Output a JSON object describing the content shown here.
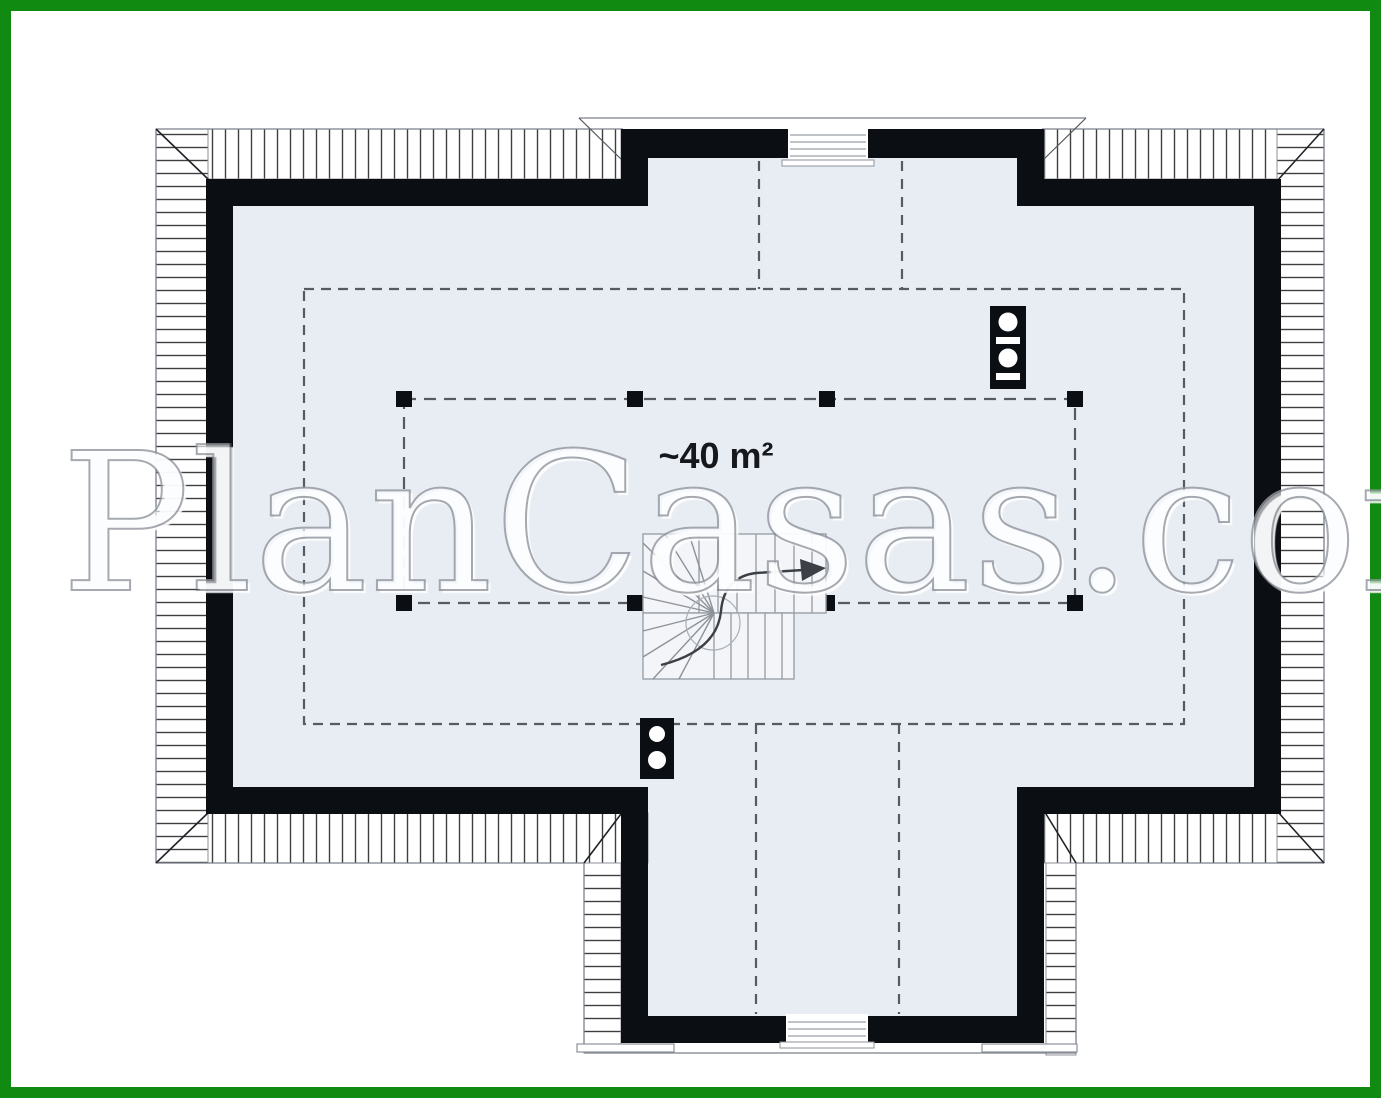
{
  "floorplan": {
    "watermark_text": "PlanCasas.com",
    "area_label": "~40 m²",
    "colors": {
      "frame_green": "#118a11",
      "background": "#ffffff",
      "wall": "#0b0e12",
      "floor": "#e8edf4",
      "dash_line": "#565b63",
      "hatch_line": "#3f3f3f",
      "stair_line": "#9aa0a8",
      "eave_line": "#7b818a"
    },
    "symbols": [
      {
        "name": "chimney-symbol",
        "count": 2
      },
      {
        "name": "winder-stair-symbol",
        "count": 1
      },
      {
        "name": "roof-window-symbol",
        "count": 2
      },
      {
        "name": "post-marker",
        "count": 8
      }
    ]
  }
}
